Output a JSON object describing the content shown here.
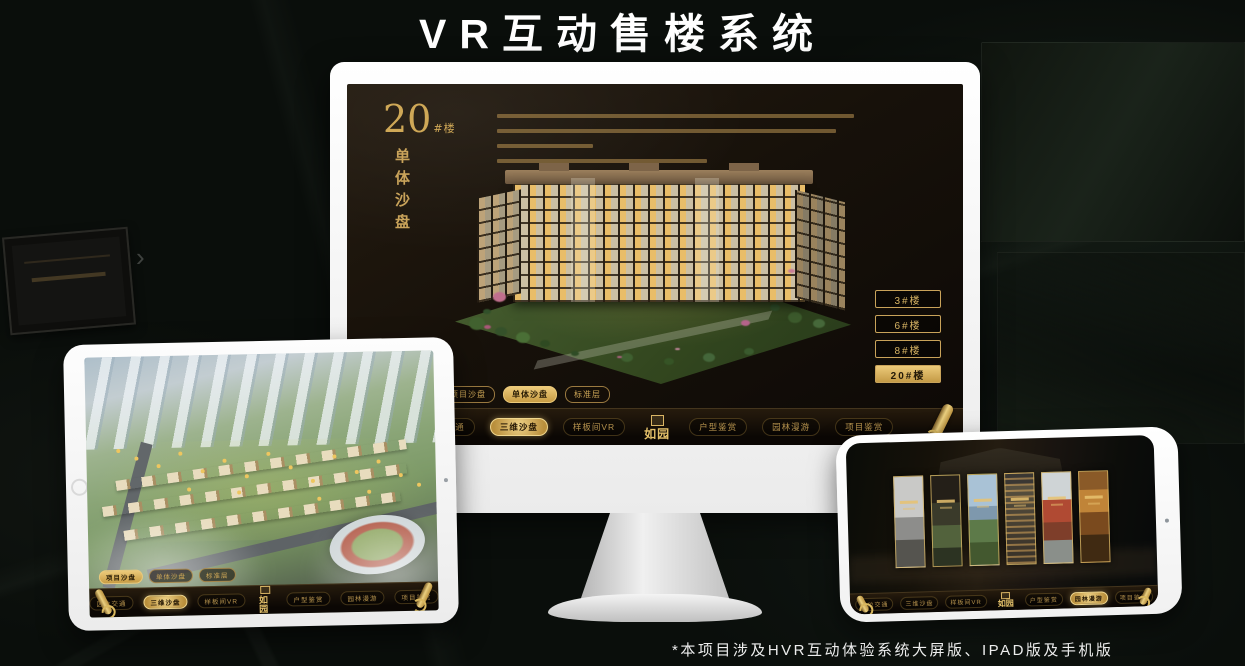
{
  "page": {
    "title": "VR互动售楼系统",
    "footnote": "*本项目涉及HVR互动体验系统大屏版、IPAD版及手机版"
  },
  "colors": {
    "gold": "#c9a35a",
    "gold_bright": "#ecca7a",
    "screen_bg": "#17110a",
    "nav_bg": "#0b0704"
  },
  "monitor": {
    "hero": {
      "number": "20",
      "number_suffix": "#楼",
      "title_vertical": "单体沙盘"
    },
    "tabs": [
      {
        "label": "项目沙盘",
        "selected": false
      },
      {
        "label": "单体沙盘",
        "selected": true
      },
      {
        "label": "标准层",
        "selected": false
      }
    ],
    "floor_buttons": [
      {
        "label": "3#楼",
        "selected": false
      },
      {
        "label": "6#楼",
        "selected": false
      },
      {
        "label": "8#楼",
        "selected": false
      },
      {
        "label": "20#楼",
        "selected": true
      }
    ],
    "nav": {
      "logo": "如园",
      "items": [
        "区位交通",
        "三维沙盘",
        "样板间VR",
        "户型鉴赏",
        "园林漫游",
        "项目鉴赏"
      ],
      "active": "三维沙盘"
    }
  },
  "tablet": {
    "tabs": [
      {
        "label": "项目沙盘",
        "selected": true
      },
      {
        "label": "单体沙盘",
        "selected": false
      },
      {
        "label": "标准层",
        "selected": false
      }
    ],
    "nav": {
      "logo": "如园",
      "items": [
        "区位交通",
        "三维沙盘",
        "样板间VR",
        "户型鉴赏",
        "园林漫游",
        "项目鉴赏"
      ],
      "active": "三维沙盘"
    }
  },
  "phone": {
    "nav": {
      "logo": "如园",
      "items": [
        "区位交通",
        "三维沙盘",
        "样板间VR",
        "户型鉴赏",
        "园林漫游",
        "项目鉴赏"
      ],
      "active": "园林漫游"
    }
  }
}
